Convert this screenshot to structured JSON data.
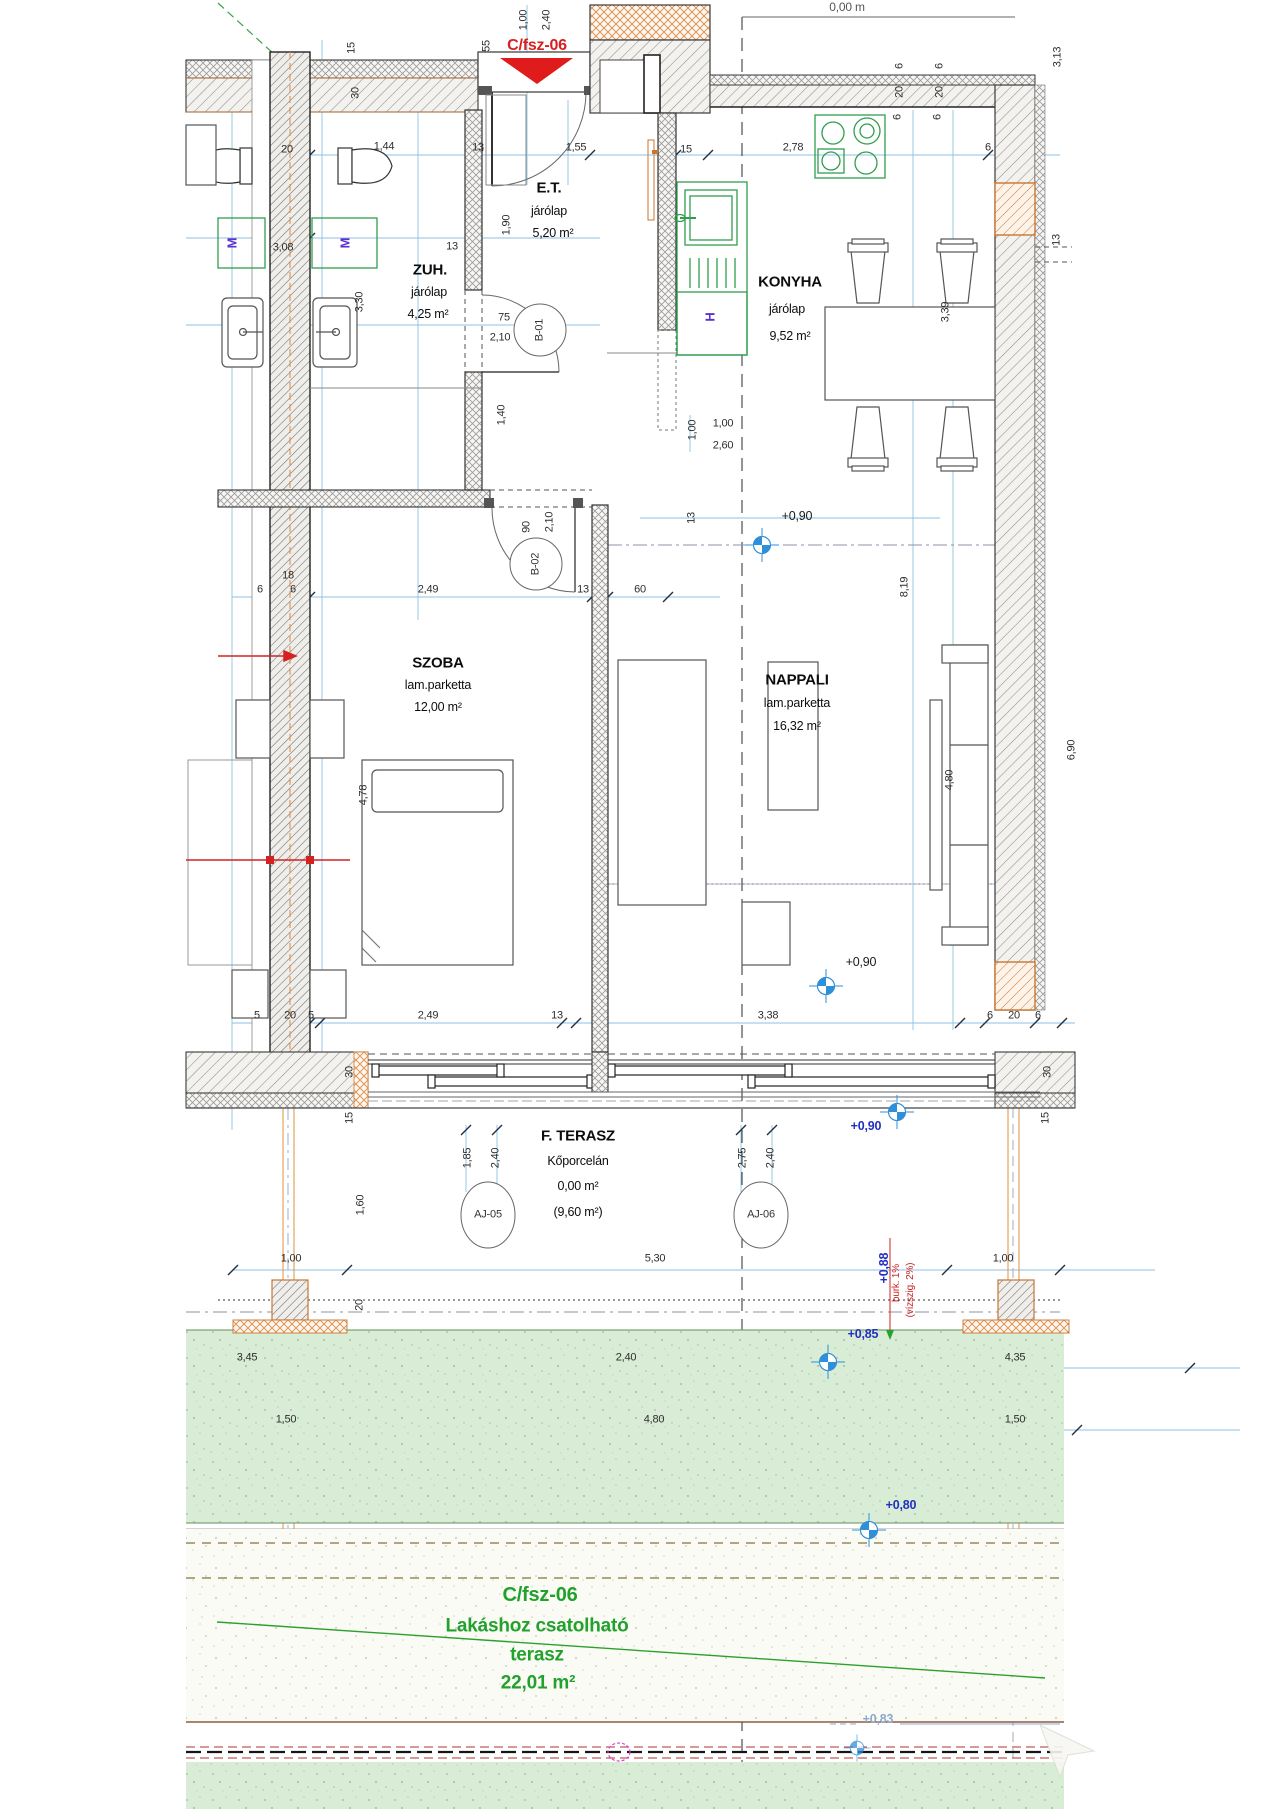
{
  "meta": {
    "unit_top": "C/fsz-06",
    "top_clipped": "0,00 m"
  },
  "rooms": [
    {
      "name": "E.T.",
      "finish": "járólap",
      "area": "5,20 m²"
    },
    {
      "name": "ZUH.",
      "finish": "járólap",
      "area": "4,25 m²"
    },
    {
      "name": "KONYHA",
      "finish": "járólap",
      "area": "9,52 m²"
    },
    {
      "name": "SZOBA",
      "finish": "lam.parketta",
      "area": "12,00 m²"
    },
    {
      "name": "NAPPALI",
      "finish": "lam.parketta",
      "area": "16,32 m²"
    },
    {
      "name": "F. TERASZ",
      "finish": "Kőporcelán",
      "area": "0,00 m²",
      "area_alt": "(9,60 m²)"
    }
  ],
  "garden": {
    "unit": "C/fsz-06",
    "line1": "Lakáshoz csatolható",
    "line2": "terasz",
    "area": "22,01 m²"
  },
  "door_tags": [
    "B-01",
    "B-02",
    "AJ-05",
    "AJ-06"
  ],
  "levels": {
    "k": "+0,90",
    "n": "+0,90",
    "t": "+0,90",
    "p88": "+0,88",
    "p85": "+0,85",
    "p80": "+0,80",
    "p83": "+0,83"
  },
  "fixtures": {
    "m1": "M",
    "m2": "M",
    "h": "H"
  },
  "notes": {
    "slope": "burk. 1%",
    "slope2": "(vízszig. 2%)"
  },
  "dims": [
    "1,00",
    "2,40",
    "55",
    "15",
    "30",
    "20",
    "1,44",
    "13",
    "1,55",
    "15",
    "2,78",
    "6",
    "6",
    "20",
    "6",
    "6",
    "20",
    "6",
    "3,13",
    "13",
    "1,90",
    "3,08",
    "3,30",
    "13",
    "75",
    "2,10",
    "1,40",
    "1,00",
    "1,00",
    "2,60",
    "3,39",
    "13",
    "90",
    "2,10",
    "6",
    "18",
    "6",
    "2,49",
    "13",
    "60",
    "8,19",
    "4,78",
    "4,80",
    "6,90",
    "5",
    "20",
    "5",
    "2,49",
    "13",
    "3,38",
    "6",
    "20",
    "6",
    "30",
    "15",
    "30",
    "15",
    "1,85",
    "2,40",
    "2,75",
    "2,40",
    "1,60",
    "1,00",
    "5,30",
    "1,00",
    "20",
    "3,45",
    "2,40",
    "4,35",
    "1,50",
    "4,80",
    "1,50"
  ]
}
